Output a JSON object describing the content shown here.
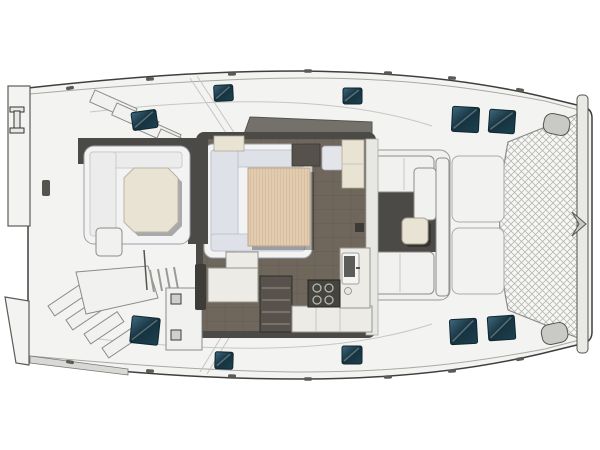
{
  "meta": {
    "description": "Top-down deck and interior layout plan of a sailing catamaran, bow to the right, stern to the left",
    "view": "overhead floor plan render",
    "visible_text": []
  },
  "colors": {
    "page_bg": "#ffffff",
    "hull_stroke": "#3f3f3d",
    "deck_fill": "#f3f3f1",
    "deck_shade": "#e7e7e4",
    "deck_line": "#a8a8a5",
    "panel_line": "#c6c6c3",
    "shadow": "#4c4a46",
    "saloon_floor": "#6f665c",
    "floor_line": "#645c52",
    "settee_back": "#f3f3f4",
    "cushion": "#dfe1e9",
    "cushion_line": "#b8bac6",
    "wood": "#e2cbae",
    "wood_line": "#cbb193",
    "cream": "#e9e3d3",
    "counter": "#edebe5",
    "counter_line": "#96968f",
    "appliance": "#45443f",
    "burner": "#b9b7b0",
    "step_dark": "#57524b",
    "hatch_deep": "#16323f",
    "hatch_mid": "#3f6a7e",
    "hatch_edge": "#0f2630",
    "net_bg": "#f7f7f5",
    "net_line": "#b7b7b3",
    "beam": "#e9e9e6",
    "dash_band": "#74716a",
    "rub_strip": "#d8d8d4",
    "fitting": "#3d3c39",
    "white_furn": "#f1f1ef"
  },
  "deck_hatches": [
    {
      "name": "port-side-deck-hatch-aft",
      "x": 132,
      "y": 111,
      "w": 25,
      "h": 18,
      "rot": -8
    },
    {
      "name": "port-side-deck-hatch-mid",
      "x": 214,
      "y": 85,
      "w": 19,
      "h": 16,
      "rot": -3
    },
    {
      "name": "port-side-deck-hatch-fwd",
      "x": 343,
      "y": 88,
      "w": 19,
      "h": 16,
      "rot": 0
    },
    {
      "name": "foredeck-hatch-port-inner",
      "x": 452,
      "y": 107,
      "w": 27,
      "h": 25,
      "rot": 3
    },
    {
      "name": "foredeck-hatch-port-outer",
      "x": 489,
      "y": 110,
      "w": 26,
      "h": 23,
      "rot": 4
    },
    {
      "name": "foredeck-hatch-stbd-inner",
      "x": 450,
      "y": 319,
      "w": 27,
      "h": 25,
      "rot": -3
    },
    {
      "name": "foredeck-hatch-stbd-outer",
      "x": 488,
      "y": 316,
      "w": 27,
      "h": 24,
      "rot": -4
    },
    {
      "name": "stbd-side-deck-hatch-aft",
      "x": 131,
      "y": 317,
      "w": 28,
      "h": 27,
      "rot": 6
    },
    {
      "name": "stbd-side-deck-hatch-mid",
      "x": 215,
      "y": 352,
      "w": 18,
      "h": 17,
      "rot": 2
    },
    {
      "name": "stbd-side-deck-hatch-fwd",
      "x": 342,
      "y": 346,
      "w": 20,
      "h": 18,
      "rot": 0
    }
  ],
  "deck_cleats": [
    {
      "x": 70,
      "y": 88,
      "rot": -10
    },
    {
      "x": 150,
      "y": 79,
      "rot": -5
    },
    {
      "x": 232,
      "y": 74,
      "rot": -2
    },
    {
      "x": 308,
      "y": 71,
      "rot": 0
    },
    {
      "x": 388,
      "y": 73,
      "rot": 2
    },
    {
      "x": 452,
      "y": 78,
      "rot": 5
    },
    {
      "x": 520,
      "y": 90,
      "rot": 9
    },
    {
      "x": 70,
      "y": 362,
      "rot": 10
    },
    {
      "x": 150,
      "y": 371,
      "rot": 5
    },
    {
      "x": 232,
      "y": 376,
      "rot": 2
    },
    {
      "x": 308,
      "y": 379,
      "rot": 0
    },
    {
      "x": 388,
      "y": 377,
      "rot": -2
    },
    {
      "x": 452,
      "y": 371,
      "rot": -5
    },
    {
      "x": 520,
      "y": 359,
      "rot": -9
    }
  ],
  "stove_burners": [
    {
      "cx": 317,
      "cy": 288
    },
    {
      "cx": 329,
      "cy": 288
    },
    {
      "cx": 317,
      "cy": 300
    },
    {
      "cx": 329,
      "cy": 300
    }
  ],
  "companionway_treads_y": [
    288,
    300,
    312,
    324
  ],
  "regions": [
    "stern-transom-platforms",
    "aft-cockpit",
    "saloon",
    "galley",
    "navigation-station",
    "forward-cockpit",
    "foredeck-lockers",
    "bow-trampoline"
  ]
}
